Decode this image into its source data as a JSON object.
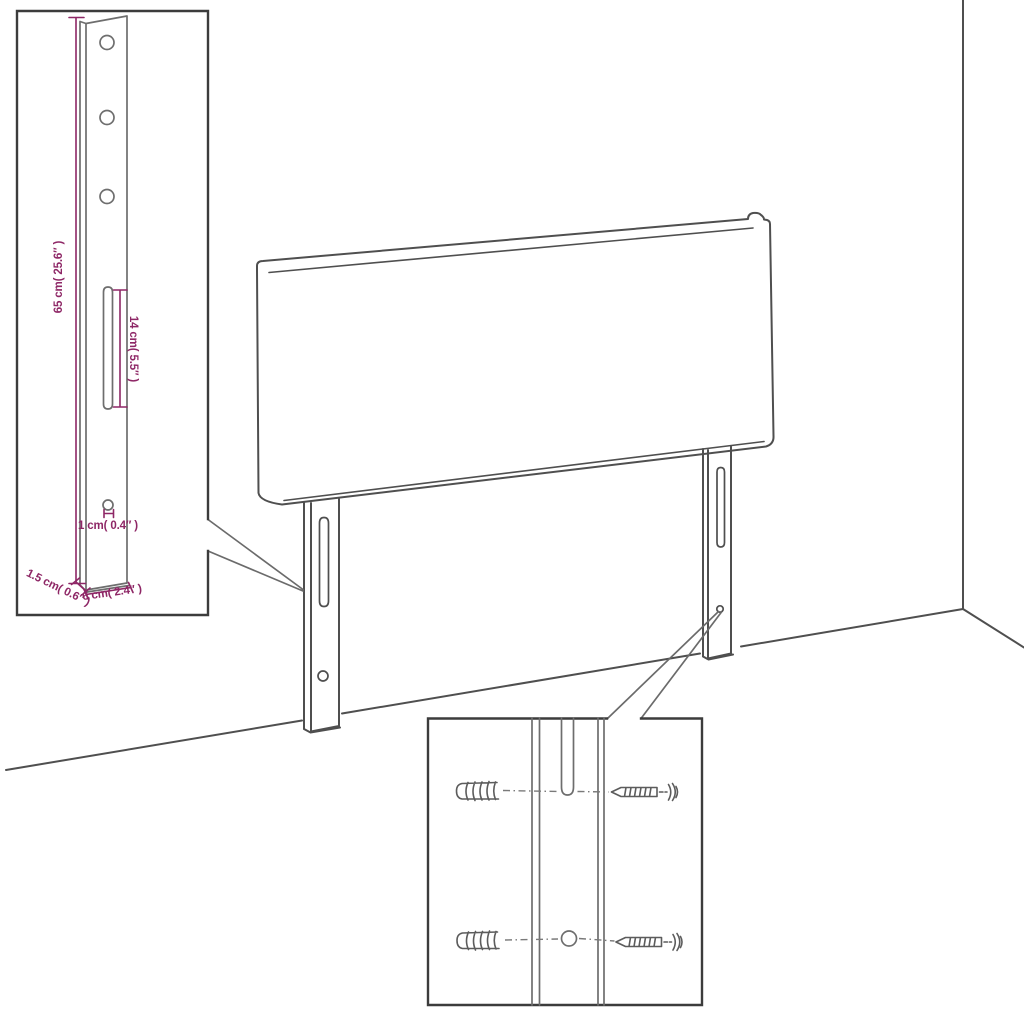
{
  "figure": {
    "colors": {
      "bg": "#ffffff",
      "line": "#4f4f4f",
      "box": "#3c3c3c",
      "detail": "#6e6e6e",
      "accent": "#8e2766"
    }
  },
  "annotations": {
    "leg_height": "65 cm( 25.6″ )",
    "slot_length": "14 cm( 5.5″ )",
    "hole_diameter": "1 cm( 0.4″ )",
    "leg_width": "6 cm( 2.4″ )",
    "leg_thickness": "1.5 cm( 0.6″ )"
  }
}
